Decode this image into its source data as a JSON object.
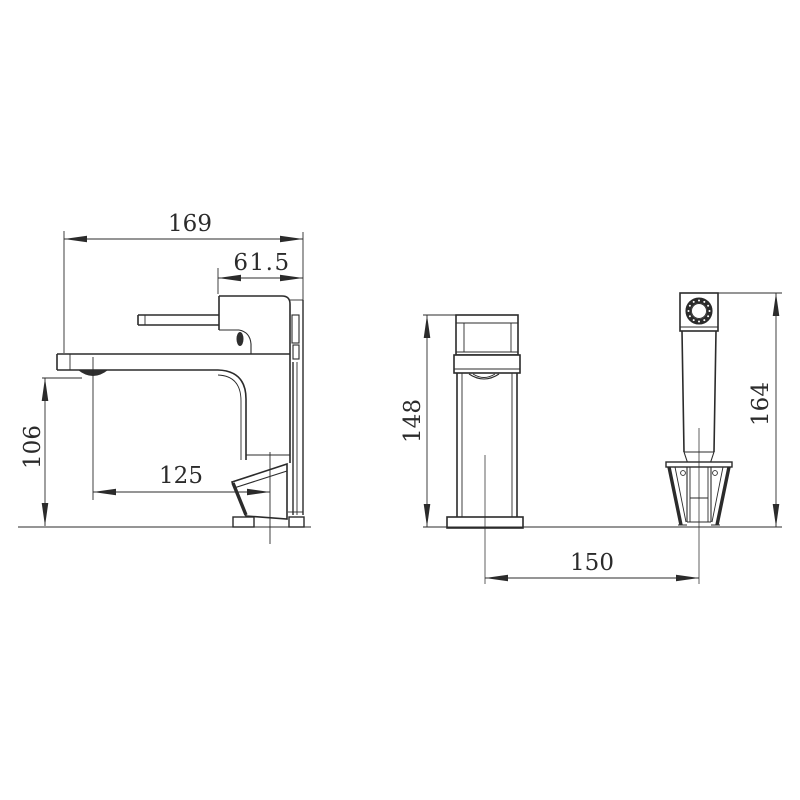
{
  "colors": {
    "line": "#2b2b2b",
    "background": "#ffffff"
  },
  "drawing": {
    "dims": {
      "d169": "169",
      "d61_5": "61.5",
      "d106": "106",
      "d125": "125",
      "d148": "148",
      "d150": "150",
      "d164": "164"
    }
  }
}
